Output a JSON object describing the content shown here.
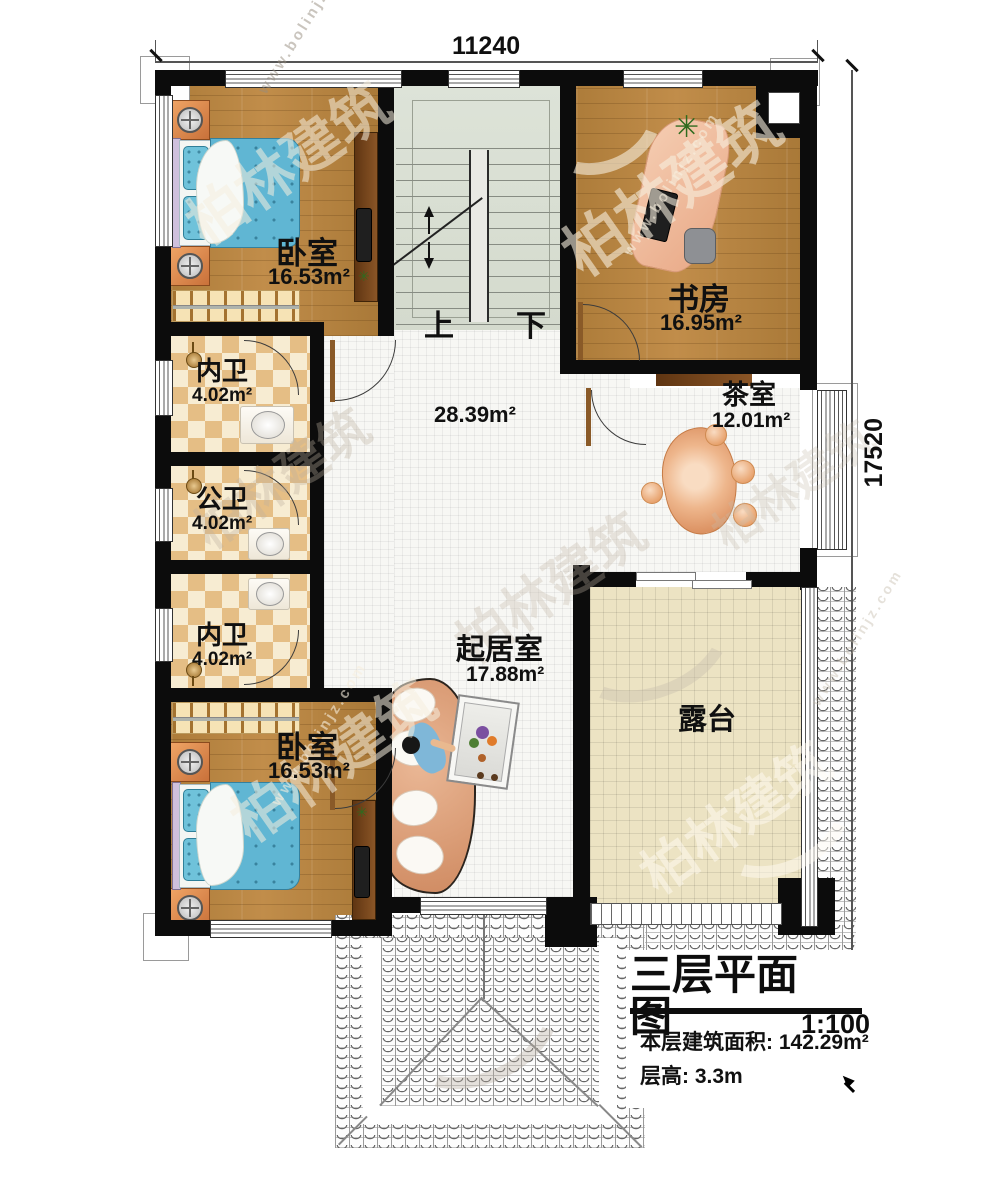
{
  "colors": {
    "wall": "#0c0c0c",
    "wood": "#b0803e",
    "checker-a": "#e5be85",
    "checker-b": "#f7ecd2",
    "tile-white": "#f7f7f4",
    "tile-beige": "#ece3c3",
    "stair-green": "#d9ded3",
    "orange-furniture": "#dd9257",
    "bed-blue": "#62b7d3",
    "desk-peach": "#eeb68c"
  },
  "dimensions": {
    "top": "11240",
    "right": "17520"
  },
  "stair": {
    "up_label": "上",
    "down_label": "下"
  },
  "rooms": {
    "bedroom_top": {
      "name": "卧室",
      "area": "16.53m²"
    },
    "study": {
      "name": "书房",
      "area": "16.95m²"
    },
    "bath_top": {
      "name": "内卫",
      "area": "4.02m²"
    },
    "bath_middle": {
      "name": "公卫",
      "area": "4.02m²"
    },
    "bath_bottom": {
      "name": "内卫",
      "area": "4.02m²"
    },
    "hall": {
      "area": "28.39m²"
    },
    "tea_room": {
      "name": "茶室",
      "area": "12.01m²"
    },
    "living_room": {
      "name": "起居室",
      "area": "17.88m²"
    },
    "bedroom_bottom": {
      "name": "卧室",
      "area": "16.53m²"
    },
    "terrace": {
      "name": "露台"
    }
  },
  "title_block": {
    "title": "三层平面图",
    "scale": "1:100",
    "area_label": "本层建筑面积:",
    "area_value": "142.29m²",
    "height_label": "层高:",
    "height_value": "3.3m"
  },
  "watermark": {
    "brand": "柏林建筑",
    "url": "www.bolinjz.com"
  },
  "icons": {
    "plant": "✳",
    "flower": "❀"
  }
}
